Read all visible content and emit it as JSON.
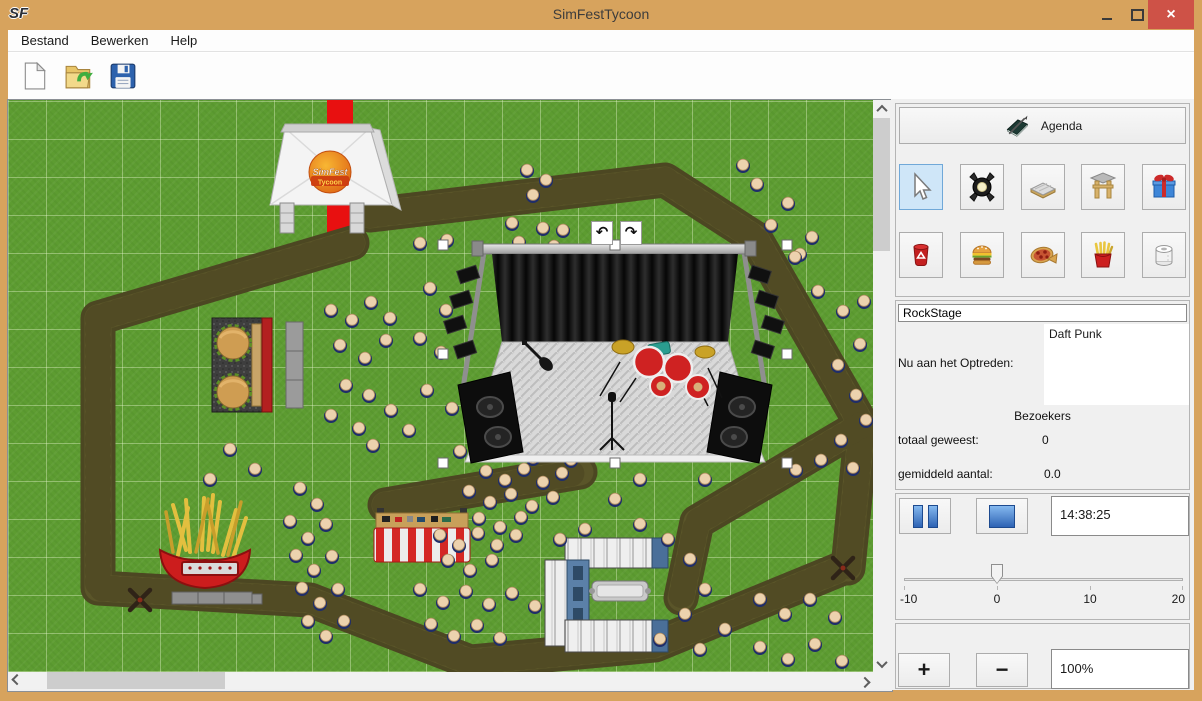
{
  "window": {
    "logo_text": "SF",
    "title": "SimFestTycoon",
    "close_icon": "×"
  },
  "menu": {
    "items": [
      "Bestand",
      "Bewerken",
      "Help"
    ]
  },
  "toolbar": {
    "buttons": [
      "new-file",
      "open-file",
      "save-file"
    ]
  },
  "canvas": {
    "tent_logo_line1": "SimFest",
    "tent_logo_line2": "Tycoon",
    "rotate_left_icon": "↶",
    "rotate_right_icon": "↷",
    "selection": {
      "x1": 435,
      "y1": 145,
      "x2": 779,
      "y2": 363
    },
    "walk_paths": [
      {
        "points": "362,115 657,80 747,138 854,325 840,468"
      },
      {
        "points": "854,325 689,422 673,498"
      },
      {
        "points": "344,143 90,218 90,488 302,500 462,562 647,545 835,468"
      },
      {
        "points": "377,405 572,372"
      }
    ],
    "turnstiles": [
      [
        835,
        468
      ],
      [
        132,
        500
      ]
    ],
    "people": [
      [
        519,
        71
      ],
      [
        538,
        81
      ],
      [
        525,
        96
      ],
      [
        504,
        124
      ],
      [
        535,
        129
      ],
      [
        511,
        143
      ],
      [
        546,
        147
      ],
      [
        555,
        131
      ],
      [
        735,
        66
      ],
      [
        749,
        85
      ],
      [
        780,
        104
      ],
      [
        804,
        138
      ],
      [
        763,
        126
      ],
      [
        792,
        155
      ],
      [
        787,
        158
      ],
      [
        810,
        192
      ],
      [
        835,
        212
      ],
      [
        852,
        245
      ],
      [
        830,
        266
      ],
      [
        848,
        296
      ],
      [
        858,
        321
      ],
      [
        833,
        341
      ],
      [
        813,
        361
      ],
      [
        845,
        369
      ],
      [
        788,
        371
      ],
      [
        856,
        202
      ],
      [
        412,
        144
      ],
      [
        439,
        141
      ],
      [
        422,
        189
      ],
      [
        438,
        211
      ],
      [
        412,
        239
      ],
      [
        433,
        253
      ],
      [
        419,
        291
      ],
      [
        444,
        309
      ],
      [
        323,
        211
      ],
      [
        344,
        221
      ],
      [
        363,
        203
      ],
      [
        382,
        219
      ],
      [
        332,
        246
      ],
      [
        357,
        259
      ],
      [
        378,
        241
      ],
      [
        338,
        286
      ],
      [
        361,
        296
      ],
      [
        323,
        316
      ],
      [
        351,
        329
      ],
      [
        383,
        311
      ],
      [
        401,
        331
      ],
      [
        365,
        346
      ],
      [
        452,
        352
      ],
      [
        470,
        341
      ],
      [
        489,
        355
      ],
      [
        507,
        347
      ],
      [
        525,
        359
      ],
      [
        544,
        350
      ],
      [
        563,
        361
      ],
      [
        478,
        372
      ],
      [
        497,
        381
      ],
      [
        516,
        370
      ],
      [
        535,
        383
      ],
      [
        554,
        374
      ],
      [
        461,
        392
      ],
      [
        482,
        403
      ],
      [
        503,
        395
      ],
      [
        524,
        407
      ],
      [
        545,
        398
      ],
      [
        471,
        419
      ],
      [
        492,
        428
      ],
      [
        513,
        418
      ],
      [
        432,
        436
      ],
      [
        451,
        446
      ],
      [
        470,
        434
      ],
      [
        489,
        446
      ],
      [
        508,
        436
      ],
      [
        440,
        461
      ],
      [
        462,
        471
      ],
      [
        484,
        461
      ],
      [
        292,
        389
      ],
      [
        309,
        405
      ],
      [
        282,
        422
      ],
      [
        300,
        439
      ],
      [
        318,
        425
      ],
      [
        288,
        456
      ],
      [
        306,
        471
      ],
      [
        324,
        457
      ],
      [
        294,
        489
      ],
      [
        312,
        504
      ],
      [
        330,
        490
      ],
      [
        300,
        522
      ],
      [
        318,
        537
      ],
      [
        336,
        522
      ],
      [
        412,
        490
      ],
      [
        435,
        503
      ],
      [
        458,
        492
      ],
      [
        481,
        505
      ],
      [
        504,
        494
      ],
      [
        527,
        507
      ],
      [
        423,
        525
      ],
      [
        446,
        537
      ],
      [
        469,
        526
      ],
      [
        492,
        539
      ],
      [
        552,
        440
      ],
      [
        577,
        430
      ],
      [
        632,
        425
      ],
      [
        660,
        440
      ],
      [
        682,
        460
      ],
      [
        697,
        490
      ],
      [
        677,
        515
      ],
      [
        652,
        540
      ],
      [
        692,
        550
      ],
      [
        717,
        530
      ],
      [
        752,
        500
      ],
      [
        777,
        515
      ],
      [
        802,
        500
      ],
      [
        827,
        518
      ],
      [
        752,
        548
      ],
      [
        780,
        560
      ],
      [
        807,
        545
      ],
      [
        834,
        562
      ],
      [
        222,
        350
      ],
      [
        247,
        370
      ],
      [
        202,
        380
      ],
      [
        632,
        380
      ],
      [
        607,
        400
      ],
      [
        697,
        380
      ]
    ]
  },
  "panel": {
    "agenda_label": "Agenda",
    "tools_row1": [
      "select",
      "spotlight",
      "path",
      "gate",
      "gift"
    ],
    "tools_row2": [
      "trash",
      "burger",
      "pizza",
      "fries",
      "toilet-paper"
    ],
    "stage_name_value": "RockStage",
    "now_performing_label": "Nu aan het Optreden:",
    "now_performing_value": "Daft Punk",
    "visitors_header": "Bezoekers",
    "total_label": "totaal geweest:",
    "total_value": "0",
    "average_label": "gemiddeld aantal:",
    "average_value": "0.0",
    "time_value": "14:38:25",
    "slider": {
      "labels": [
        "-10",
        "0",
        "10",
        "20"
      ],
      "value": 0
    },
    "zoom_in_label": "+",
    "zoom_out_label": "−",
    "zoom_value": "100%"
  },
  "colors": {
    "frame": "#d7a35d",
    "close_button": "#ce5247",
    "selected_tool_bg": "#cfe6f8",
    "selected_tool_border": "#70a8d8",
    "grass": "#5d9c31",
    "path": "#56512a",
    "carpet": "#e81010"
  }
}
